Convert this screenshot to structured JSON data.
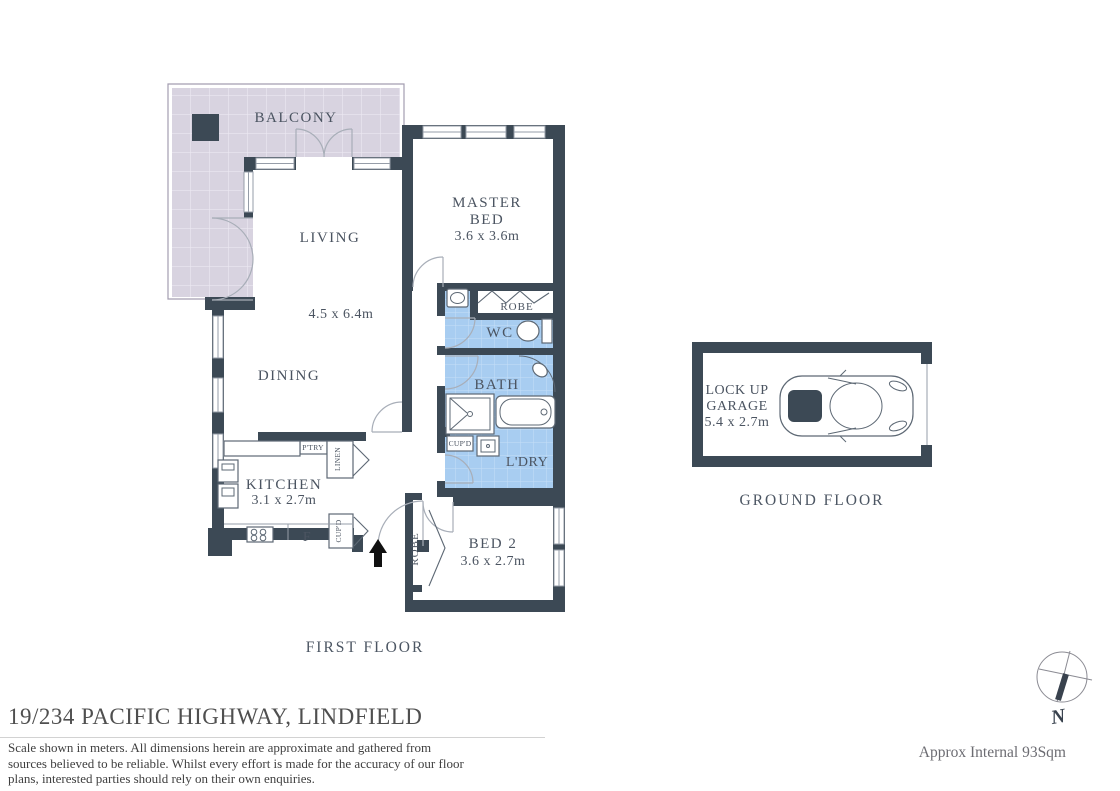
{
  "first_floor": {
    "title": "FIRST FLOOR",
    "balcony_label": "BALCONY",
    "living_label": "LIVING",
    "living_dims": "4.5 x 6.4m",
    "dining_label": "DINING",
    "kitchen_label": "KITCHEN",
    "kitchen_dims": "3.1 x 2.7m",
    "fridge_label": "F",
    "kitchen_cupboard_label": "CUP'D",
    "pantry_label": "P'TRY",
    "linen_label": "LINEN",
    "master_bed_label_line1": "MASTER",
    "master_bed_label_line2": "BED",
    "master_bed_dims": "3.6 x 3.6m",
    "master_robe_label": "ROBE",
    "wc_label": "WC",
    "bath_label": "BATH",
    "laundry_label": "L'DRY",
    "laundry_cupboard_label": "CUP'D",
    "bed2_label": "BED 2",
    "bed2_dims": "3.6 x 2.7m",
    "bed2_robe_label": "ROBE"
  },
  "ground_floor": {
    "title": "GROUND FLOOR",
    "garage_label_line1": "LOCK UP",
    "garage_label_line2": "GARAGE",
    "garage_dims": "5.4 x 2.7m"
  },
  "compass": {
    "north_label": "N"
  },
  "footer": {
    "address": "19/234 PACIFIC HIGHWAY, LINDFIELD",
    "disclaimer_lines": [
      "Scale shown in meters. All dimensions herein are approximate and gathered from",
      "sources believed to be reliable. Whilst every effort is made for the accuracy of our floor",
      "plans, interested parties should rely on their own enquiries."
    ],
    "area_note": "Approx Internal 93Sqm"
  },
  "colors": {
    "wall": "#3c4955",
    "wet_area_fill": "#a8cdf1",
    "balcony_fill": "#d8d3e0",
    "plan_text": "#4b5461",
    "footer_text": "#4f4f4f"
  }
}
